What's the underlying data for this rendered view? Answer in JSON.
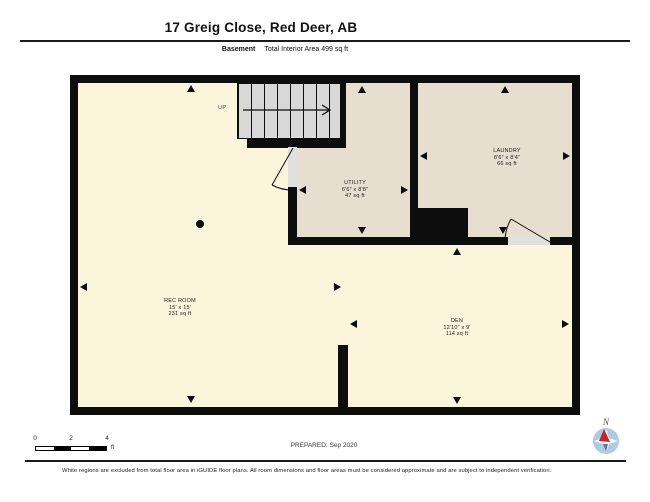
{
  "header": {
    "title": "17 Greig Close, Red Deer, AB",
    "floor_label": "Basement",
    "area_label": "Total Interior Area 499 sq ft"
  },
  "rooms": [
    {
      "name": "REC ROOM",
      "dims": "15' x 15'",
      "area": "231 sq ft"
    },
    {
      "name": "UTILITY",
      "dims": "6'6\" x 8'8\"",
      "area": "47 sq ft"
    },
    {
      "name": "LAUNDRY",
      "dims": "8'6\" x 8'4\"",
      "area": "66 sq ft"
    },
    {
      "name": "DEN",
      "dims": "12'10\" x 9'",
      "area": "114 sq ft"
    }
  ],
  "stairs": {
    "direction_label": "UP"
  },
  "scale_bar": {
    "ticks": [
      "0",
      "2",
      "4"
    ],
    "unit": "ft"
  },
  "footer": {
    "prepared": "PREPARED: Sep 2020",
    "compass_label": "N",
    "disclaimer": "White regions are excluded from total floor area in iGUIDE floor plans. All room dimensions and floor areas must be considered approximate and are subject to independent verification."
  },
  "colors": {
    "wall": "#0d0d0d",
    "included_floor": "#fbf5dc",
    "excluded_floor": "#e6dfd0",
    "stairs": "#d8d8d8",
    "door_threshold": "#e0e0e0",
    "compass_blue": "#aecbe6",
    "compass_needle_red": "#cc2222"
  }
}
